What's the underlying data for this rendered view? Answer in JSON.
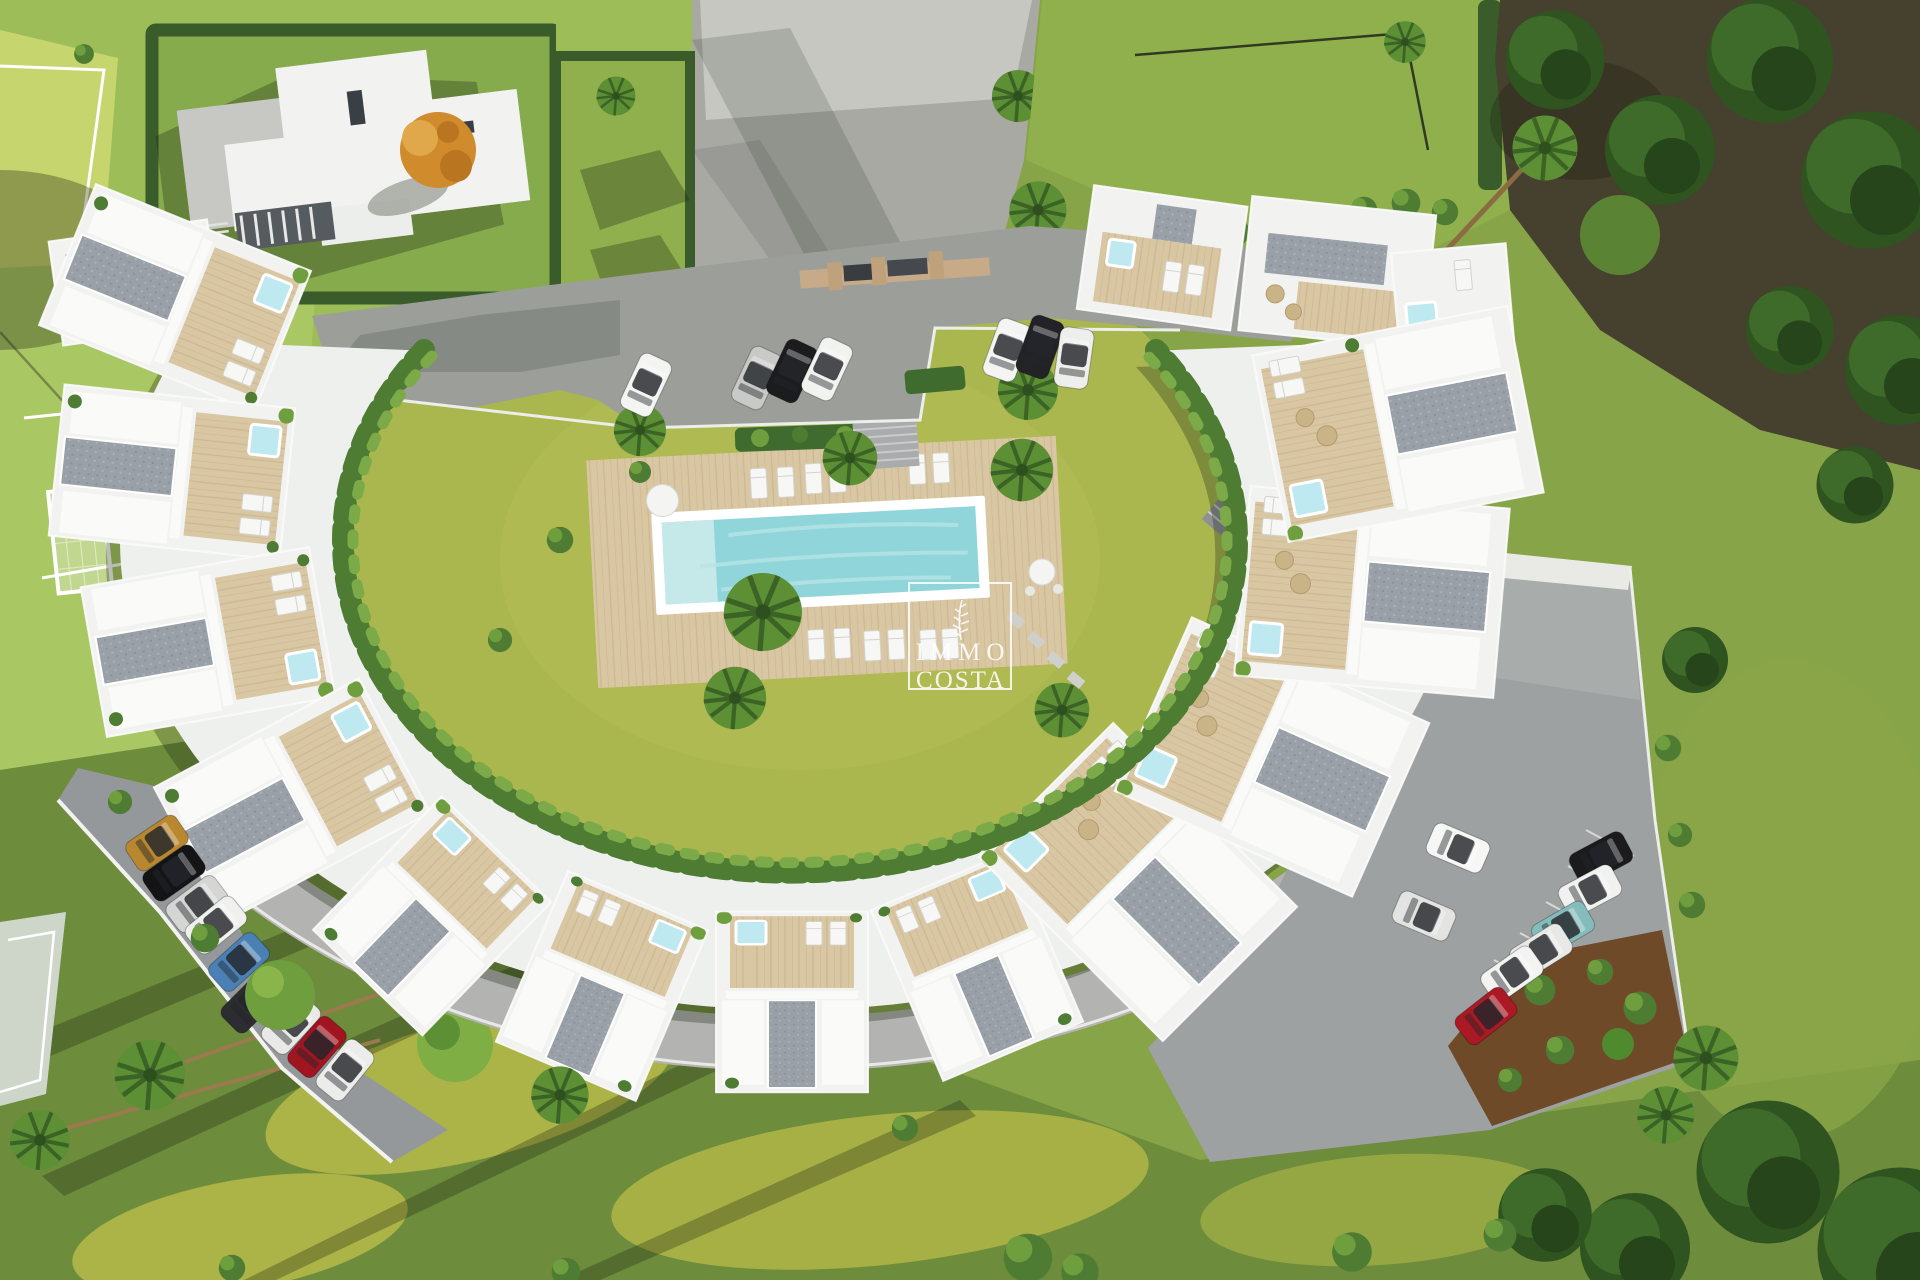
{
  "scene": {
    "type": "aerial-architectural-render",
    "description": "Top-down 3D render of a crescent-shaped white apartment complex with roof terraces, communal lawn and pool, surrounded by parking, a football pitch, gardens and trees",
    "watermark": {
      "line1": "IMMO",
      "line2": "COSTA",
      "logo": "palm-sprig-line-art",
      "color": "#ffffff"
    },
    "counts": {
      "building_modules": 13,
      "pools": 1,
      "sun_loungers_pool_top": 6,
      "sun_loungers_pool_bottom": 6,
      "cars_total": 24
    },
    "cars": {
      "top_left": [
        "#f4f4f2",
        "#c9cac8",
        "#1c1c1f",
        "#f2f2f0"
      ],
      "top_right": [
        "#f4f4f2",
        "#232327",
        "#eeeeec"
      ],
      "west_row": [
        "#b9872f",
        "#141417",
        "#d5d6d4",
        "#f0f1ef",
        "#4b80b4",
        "#2c2d31",
        "#e9eae8",
        "#a11521",
        "#ececea"
      ],
      "east_col": [
        "#f6f6f4",
        "#e3e4e2"
      ],
      "east_row": [
        "#1b1b1e",
        "#f1f1ef",
        "#84bcbc",
        "#e8e9e7",
        "#f3f3f1",
        "#ab1a24"
      ]
    },
    "palette": {
      "lawn_base": "#87a449",
      "field_green": "#a9c763",
      "court_green": "#c6d56e",
      "courtyard_lawn": "#aab74f",
      "bottom_lawn_dark": "#6d8c3c",
      "lawn_yellow_patch": "#bcbf4a",
      "driveway_gray": "#a9a9a4",
      "road_gray": "#9c9e9a",
      "parking_gray": "#95989a",
      "building_white": "#f2f3f1",
      "deck_beige": "#d9c7a3",
      "gravel_gray": "#9aa0a8",
      "pool_water": "#8fd5da",
      "jacuzzi_blue": "#bfe9f0",
      "hedge_dark": "#3a5c2a",
      "tree_canopy": "#2f5420",
      "forest_floor": "#45412e",
      "soil_brown": "#6e4a28",
      "watermark_white": "#ffffff"
    }
  }
}
